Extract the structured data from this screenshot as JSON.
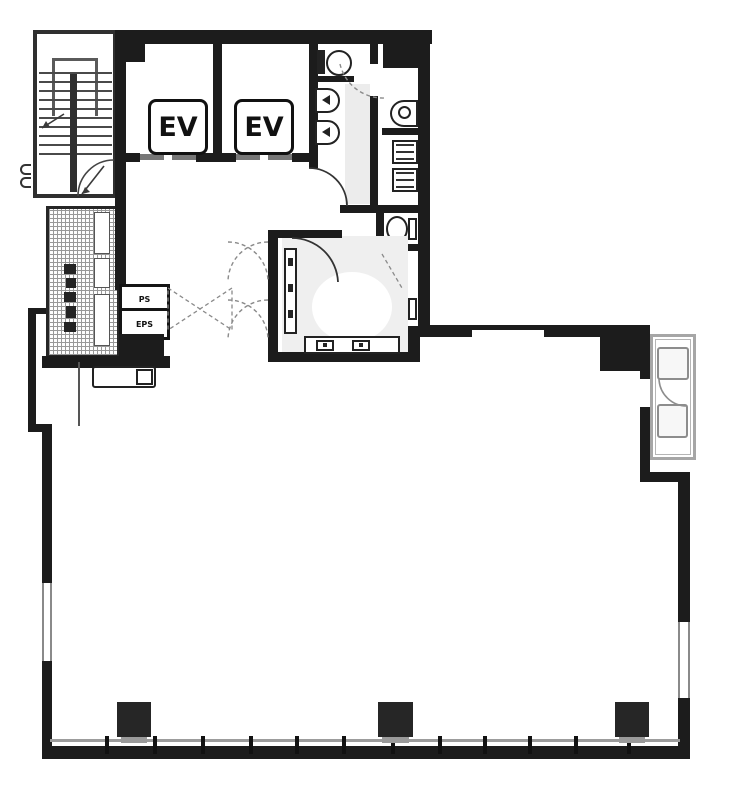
{
  "plan": {
    "type": "building-floor-plan",
    "labels": {
      "ev": "EV",
      "ps": "PS",
      "eps": "EPS"
    },
    "colors": {
      "wall": "#1c1c1c",
      "wall_medium": "#3f3f3f",
      "line_gray": "#8f8f8f",
      "balcony_outline": "#a6a6a6",
      "light_fill": "#efefef",
      "background": "#ffffff"
    },
    "icons": {
      "stairs": "stairs-icon",
      "elevator_shaft": "elevator-shaft",
      "urinal": "urinal-icon",
      "toilet": "toilet-icon",
      "washbasin": "washbasin-icon",
      "outdoor_unit": "outdoor-unit-icon",
      "column": "structural-column",
      "pipe_shaft": "pipe-shaft",
      "service_hatch": "hatched-void"
    },
    "counts": {
      "elevators": 2,
      "urinals": 2,
      "toilets": 3,
      "washbasins": 1,
      "columns": 3,
      "outdoor_units": 2,
      "window_mullions": 12
    }
  }
}
